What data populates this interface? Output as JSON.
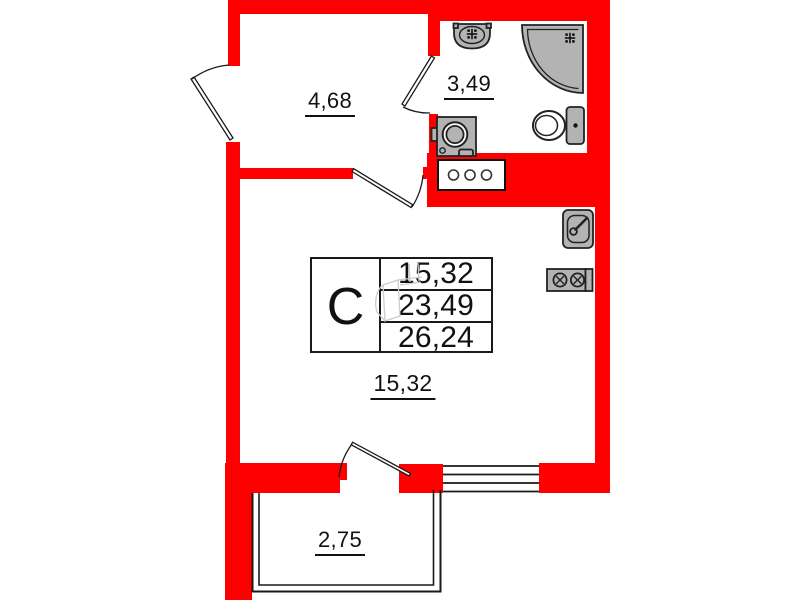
{
  "unit": {
    "type_label": "С",
    "area_rows": [
      "15,32",
      "23,49",
      "26,24"
    ]
  },
  "areas": {
    "hallway": "4,68",
    "bathroom": "3,49",
    "living": "15,32",
    "balcony": "2,75"
  },
  "icons": [
    "bath-sink-icon",
    "corner-shower-icon",
    "toilet-icon",
    "washing-machine-icon",
    "ventilation-shaft-icon",
    "kitchen-sink-icon",
    "stove-icon",
    "door-swing-icon",
    "window-icon"
  ],
  "colors": {
    "wall": "#ff0000",
    "fixture_fill": "#b3b3b3",
    "fixture_stroke": "#222222",
    "line": "#1a1a1a"
  }
}
